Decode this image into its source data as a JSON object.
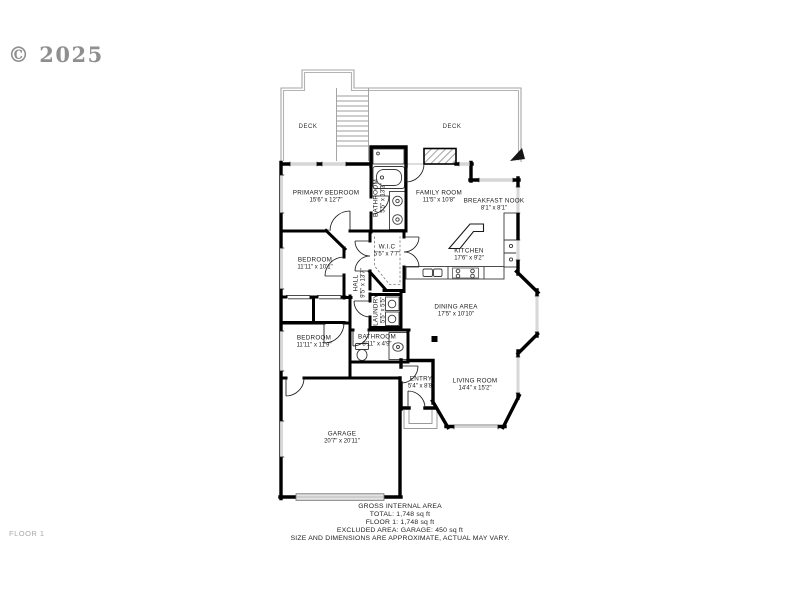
{
  "watermark": "© 2025",
  "floor_label": "FLOOR 1",
  "rooms": {
    "deck_left": {
      "name": "DECK"
    },
    "deck_right": {
      "name": "DECK"
    },
    "primary_bedroom": {
      "name": "PRIMARY BEDROOM",
      "dims": "15'6\" x 12'7\""
    },
    "primary_bathroom": {
      "name": "BATHROOM",
      "dims": "5'5\" x 13'3\""
    },
    "family_room": {
      "name": "FAMILY ROOM",
      "dims": "11'5\" x 10'8\""
    },
    "breakfast_nook": {
      "name": "BREAKFAST NOOK",
      "dims": "8'1\" x 8'1\""
    },
    "walk_in_closet": {
      "name": "W.I.C",
      "dims": "5'5\" x 7'7\""
    },
    "kitchen": {
      "name": "KITCHEN",
      "dims": "17'6\" x 9'2\""
    },
    "bedroom_2": {
      "name": "BEDROOM",
      "dims": "11'11\" x 10'1\""
    },
    "hall": {
      "name": "HALL",
      "dims": "9'5\" x 13'7\""
    },
    "laundry": {
      "name": "LAUNDRY",
      "dims": "5'5\" x 5'5\""
    },
    "dining_area": {
      "name": "DINING AREA",
      "dims": "17'5\" x 10'10\""
    },
    "bedroom_3": {
      "name": "BEDROOM",
      "dims": "11'11\" x 11'9\""
    },
    "bathroom_2": {
      "name": "BATHROOM",
      "dims": "8'11\" x 4'9\""
    },
    "entry": {
      "name": "ENTRY",
      "dims": "5'4\" x 8'8\""
    },
    "living_room": {
      "name": "LIVING ROOM",
      "dims": "14'4\" x 15'2\""
    },
    "garage": {
      "name": "GARAGE",
      "dims": "20'7\" x 20'11\""
    }
  },
  "footer": {
    "line1": "GROSS INTERNAL AREA",
    "line2": "TOTAL: 1,748 sq ft",
    "line3": "FLOOR 1: 1,748 sq ft",
    "line4": "EXCLUDED AREA: GARAGE: 450 sq ft",
    "line5": "SIZE AND DIMENSIONS ARE APPROXIMATE, ACTUAL MAY VARY."
  },
  "colors": {
    "walls": "#000000",
    "windows": "#bdbdbd",
    "deck_outline": "#a6a6a6",
    "watermark": "#8f8f8f",
    "labels": "#1b1b1b"
  }
}
